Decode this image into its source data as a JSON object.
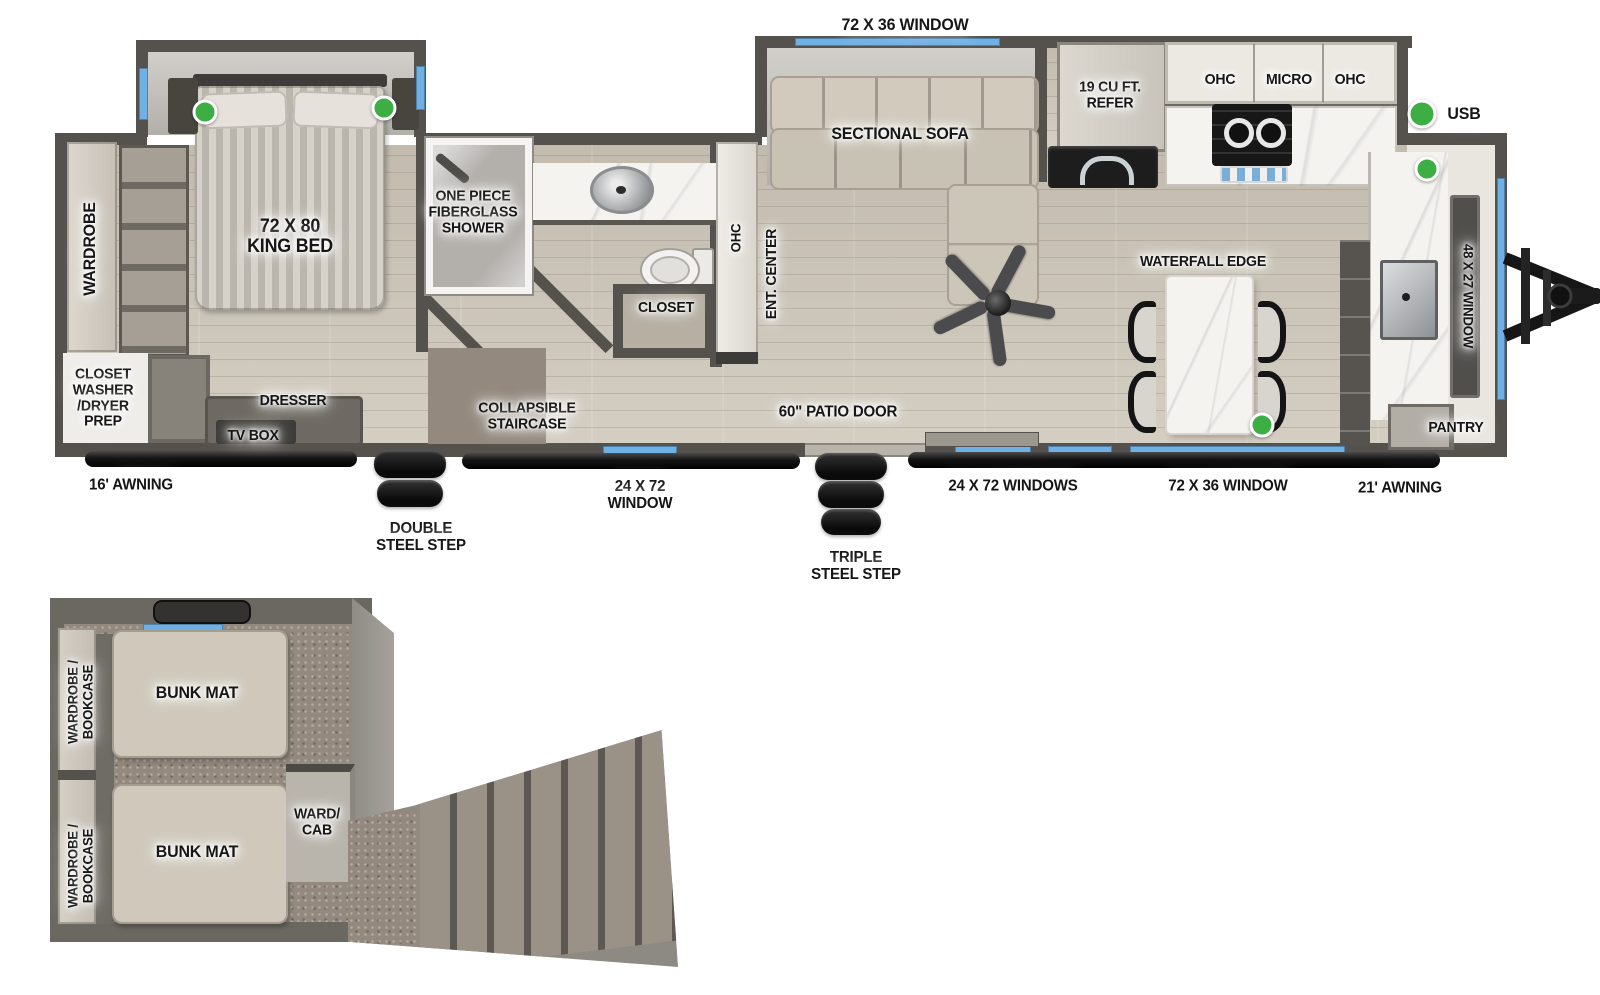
{
  "colors": {
    "wall": "#55524e",
    "floor_wood": "#c9c2b6",
    "floor_slide": "#c2bfb9",
    "carpet": "#93897e",
    "window_blue": "#6fb1e4",
    "usb_green": "#3cae44",
    "label_text": "#161616",
    "marble": "#f5f3ef",
    "steel_black": "#111111"
  },
  "main_plan": {
    "windows": {
      "sofa_top": "72 X 36 WINDOW",
      "bath_bottom": "24 X 72\nWINDOW",
      "kitchen_pair": "24 X 72 WINDOWS",
      "island_bottom": "72 X 36 WINDOW",
      "front": "48 X 27 WINDOW"
    },
    "awnings": {
      "rear": "16' AWNING",
      "front": "21' AWNING"
    },
    "steps": {
      "double": "DOUBLE\nSTEEL STEP",
      "triple": "TRIPLE\nSTEEL STEP"
    },
    "patio_door": "60\" PATIO DOOR",
    "bedroom": {
      "king_bed": "72 X 80\nKING BED",
      "wardrobe": "WARDROBE",
      "closet_washer_dryer": "CLOSET\nWASHER\n/DRYER\nPREP",
      "dresser": "DRESSER",
      "tv_box": "TV BOX"
    },
    "bathroom": {
      "shower": "ONE PIECE\nFIBERGLASS\nSHOWER",
      "closet": "CLOSET",
      "staircase": "COLLAPSIBLE\nSTAIRCASE"
    },
    "living": {
      "sofa": "SECTIONAL SOFA",
      "ohc": "OHC",
      "ent_center": "ENT. CENTER"
    },
    "kitchen": {
      "refer": "19 CU FT.\nREFER",
      "ohc_left": "OHC",
      "micro": "MICRO",
      "ohc_right": "OHC",
      "island_edge": "WATERFALL EDGE",
      "pantry": "PANTRY"
    },
    "legend": {
      "usb": "USB"
    }
  },
  "loft_plan": {
    "bunk_top": "BUNK MAT",
    "bunk_bottom": "BUNK MAT",
    "wardrobe_top": "WARDROBE /\nBOOKCASE",
    "wardrobe_bottom": "WARDROBE /\nBOOKCASE",
    "ward_cab": "WARD/\nCAB"
  }
}
